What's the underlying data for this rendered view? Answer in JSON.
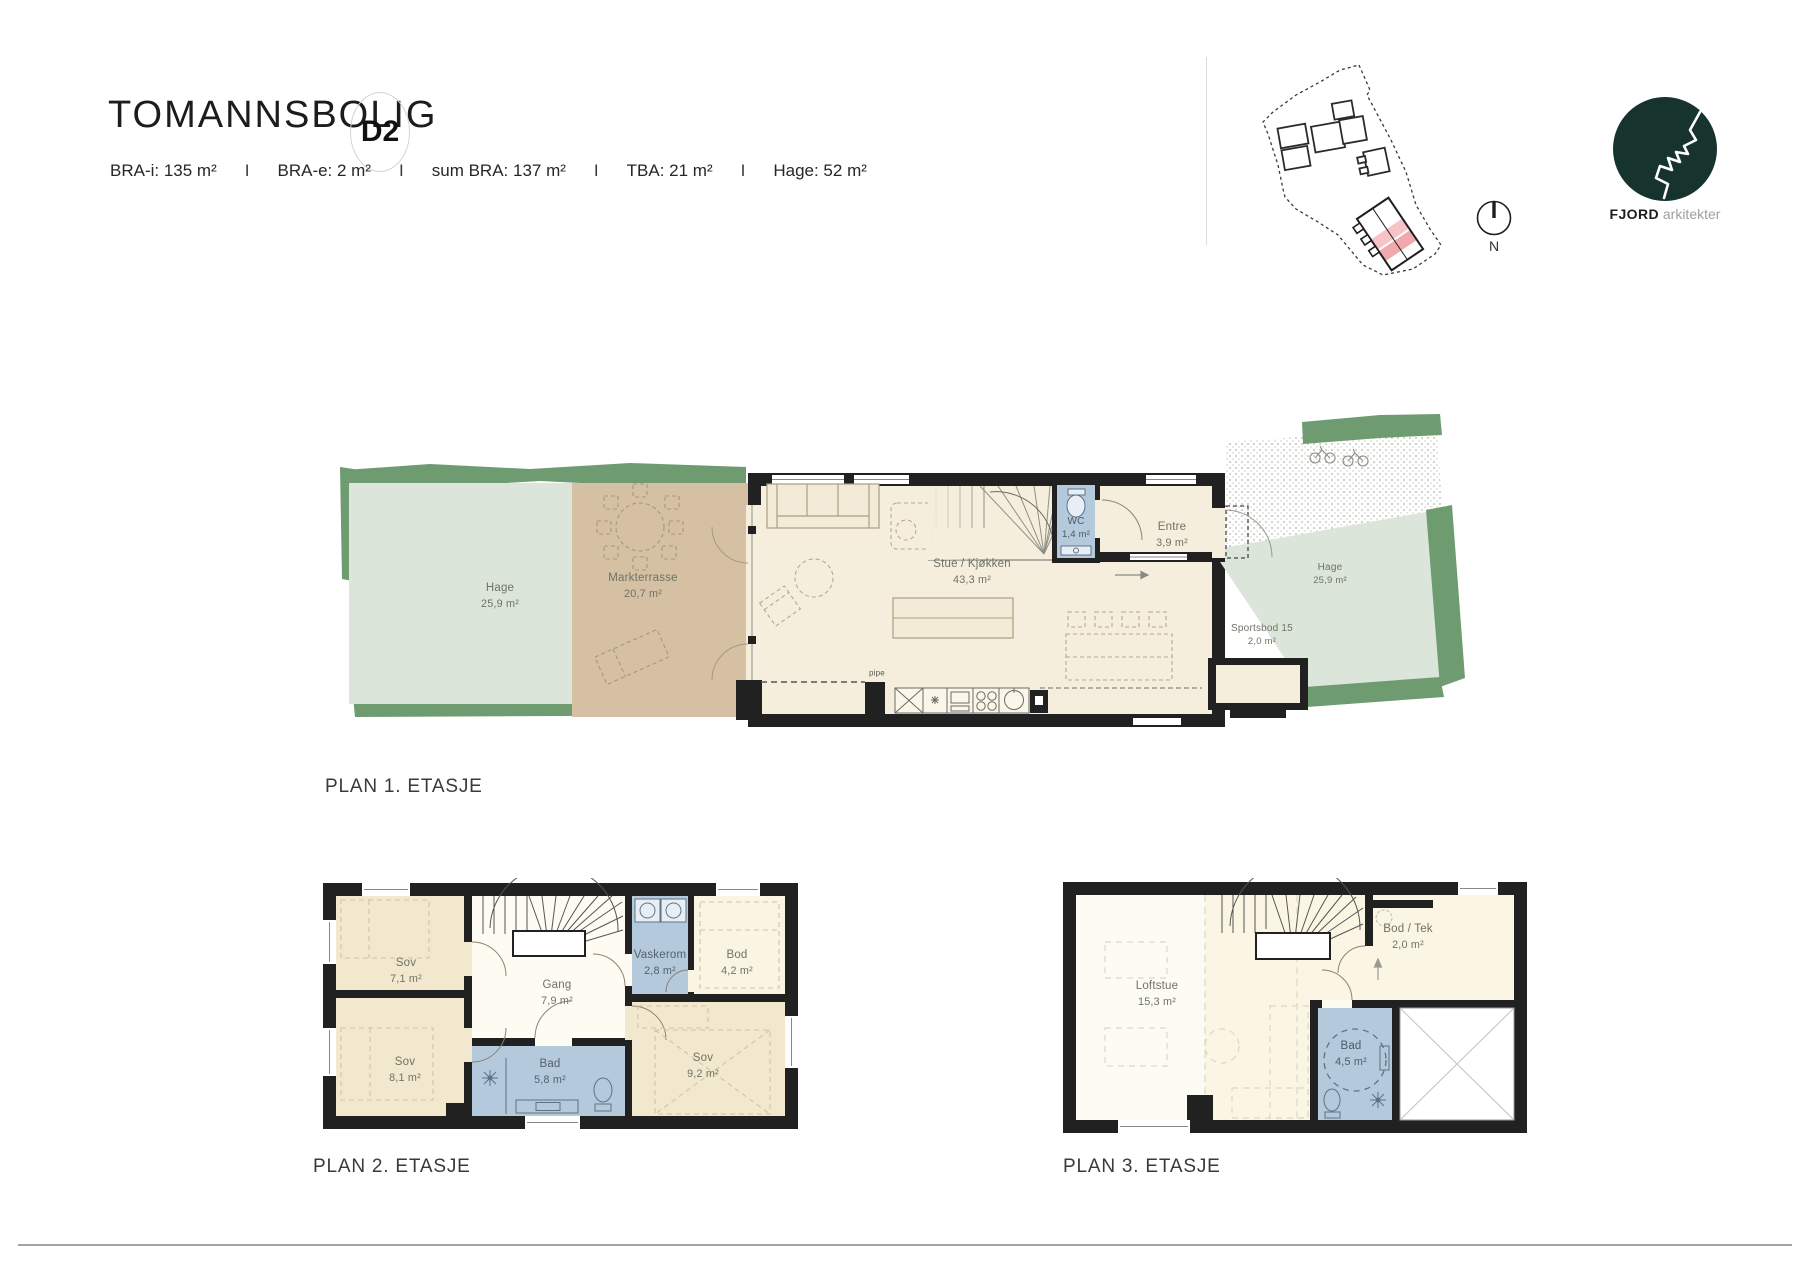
{
  "header": {
    "title": "TOMANNSBOLIG",
    "unit_badge": "D2",
    "separator": "I",
    "specs": {
      "bra_i": "BRA-i: 135 m²",
      "bra_e": "BRA-e: 2 m²",
      "sum_bra": "sum BRA: 137 m²",
      "tba": "TBA: 21 m²",
      "hage": "Hage: 52 m²"
    }
  },
  "branding": {
    "compass_label": "N",
    "logo_name": "FJORD",
    "logo_suffix": "arkitekter"
  },
  "plan1": {
    "title": "PLAN 1. ETASJE",
    "rooms": {
      "hage_left": {
        "name": "Hage",
        "area": "25,9 m²"
      },
      "markterrasse": {
        "name": "Markterrasse",
        "area": "20,7 m²"
      },
      "stue_kjokken": {
        "name": "Stue / Kjøkken",
        "area": "43,3 m²"
      },
      "wc": {
        "name": "WC",
        "area": "1,4 m²"
      },
      "entre": {
        "name": "Entre",
        "area": "3,9 m²"
      },
      "sportsbod": {
        "name": "Sportsbod 15",
        "area": "2,0 m²"
      },
      "hage_right": {
        "name": "Hage",
        "area": "25,9 m²"
      }
    },
    "annotations": {
      "pipe": "pipe"
    }
  },
  "plan2": {
    "title": "PLAN 2. ETASJE",
    "rooms": {
      "sov1": {
        "name": "Sov",
        "area": "7,1 m²"
      },
      "gang": {
        "name": "Gang",
        "area": "7,9 m²"
      },
      "vaskerom": {
        "name": "Vaskerom",
        "area": "2,8 m²"
      },
      "bod": {
        "name": "Bod",
        "area": "4,2 m²"
      },
      "sov2": {
        "name": "Sov",
        "area": "8,1 m²"
      },
      "bad": {
        "name": "Bad",
        "area": "5,8 m²"
      },
      "sov3": {
        "name": "Sov",
        "area": "9,2 m²"
      }
    }
  },
  "plan3": {
    "title": "PLAN 3. ETASJE",
    "rooms": {
      "loftstue": {
        "name": "Loftstue",
        "area": "15,3 m²"
      },
      "bod_tek": {
        "name": "Bod / Tek",
        "area": "2,0 m²"
      },
      "bad": {
        "name": "Bad",
        "area": "4,5 m²"
      }
    }
  },
  "colors": {
    "wall": "#212121",
    "floor_cream": "#f6eedd",
    "floor_beige": "#f2e8cd",
    "wet_room_blue": "#b4c9dc",
    "garden_light_green": "#dbe5d9",
    "garden_dark_green": "#6f9b71",
    "terrace_tan": "#d5c0a4",
    "site_highlight_pink": "#f2a9ad",
    "logo_teal": "#17332e"
  }
}
